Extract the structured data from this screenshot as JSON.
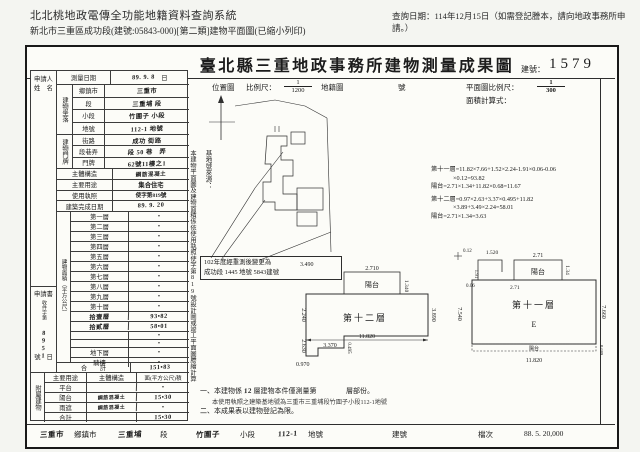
{
  "sys": {
    "title": "北北桃地政電傳全功能地籍資料查詢系統",
    "date_note": "查詢日期：114年12月15日（如需登記謄本，請向地政事務所申請。）",
    "subtitle": "新北市三重區成功段(建號:05843-000)[第二類]建物平面圖(已縮小列印)"
  },
  "doc": {
    "title": "臺北縣三重地政事務所建物測量成果圖",
    "bno_label": "建號：",
    "bno": "1579",
    "hdr": {
      "loc": "位置圖",
      "scale": "比例尺：",
      "s1n": "1",
      "s1d": "1200",
      "cad": "地籍圖",
      "no": "號",
      "pscale": "平面圖比例尺：",
      "s2n": "1",
      "s2d": "300",
      "formula": "面積計算式："
    },
    "vnote": "本建物平面圖及建物面積係依使用執照使字第819號設計圖或竣工平面圖謄繪計算",
    "base_src": "基地號來源：",
    "renote1": "102年度經重測後變更為",
    "renote2": "成功段 1445 地號 5843建號",
    "formulas": [
      "第十一層=11.82×7.66+1.52×2.24-1.91×0.06-0.06",
      "×0.12=93.82",
      "陽台=2.71×1.34+11.82×0.68=11.67",
      "第十二層=0.97×2.63+3.37×0.495+11.82",
      "×3.89+3.49×2.24=58.01",
      "陽台=2.71×1.34=3.63"
    ],
    "lt": {
      "applicant1": "申請人",
      "applicant2": "姓　名",
      "appbox": {
        "title": "申請書",
        "sub": "收件字第",
        "hand": "8951",
        "no": "號",
        "day": "日"
      },
      "survey_label": "測量日期",
      "survey_value": "89. 9. 8",
      "survey_suffix": "日",
      "loc_label": "建物坐落",
      "loc_rows": [
        {
          "l": "鄉鎮市",
          "v": "三重市"
        },
        {
          "l": "段",
          "v": "三重埔 段"
        },
        {
          "l": "小段",
          "v": "竹圍子 小段"
        },
        {
          "l": "地號",
          "v": "112-1 地號"
        }
      ],
      "door_label": "建物門牌",
      "door_rows": [
        {
          "l": "街路",
          "v": "成功 街路"
        },
        {
          "l": "段巷弄",
          "v": "段 50 巷　弄"
        },
        {
          "l": "門牌",
          "v": "62號11樓之1"
        }
      ],
      "rows": [
        {
          "l": "主體構造",
          "v": "鋼筋混凝土"
        },
        {
          "l": "主要用途",
          "v": "集合住宅"
        },
        {
          "l": "使用執照",
          "v": "使字第819號"
        },
        {
          "l": "建築完成日期",
          "v": "89. 9. 20"
        }
      ],
      "area_label": "建物面積（平方公尺）",
      "floors": [
        {
          "label": "第一層",
          "value": "•"
        },
        {
          "label": "第二層",
          "value": "•"
        },
        {
          "label": "第三層",
          "value": "•"
        },
        {
          "label": "第四層",
          "value": "•"
        },
        {
          "label": "第五層",
          "value": "•"
        },
        {
          "label": "第六層",
          "value": "•"
        },
        {
          "label": "第七層",
          "value": "•"
        },
        {
          "label": "第八層",
          "value": "•"
        },
        {
          "label": "第九層",
          "value": "•"
        },
        {
          "label": "第十層",
          "value": "•"
        },
        {
          "label": "拾壹層",
          "value": "93•82"
        },
        {
          "label": "拾貳層",
          "value": "58•01"
        },
        {
          "label": "",
          "value": "•"
        },
        {
          "label": "",
          "value": "•"
        },
        {
          "label": "地下層",
          "value": "•"
        },
        {
          "label": "騎樓",
          "value": "•"
        }
      ],
      "total_label": "合　　計",
      "total_value": "151•83",
      "annex_label": "附屬建物",
      "annex_headers": [
        "主要用途",
        "主體構造",
        "面(平方公尺)積"
      ],
      "annex_rows": [
        {
          "use": "平台",
          "structure": "",
          "area": "•"
        },
        {
          "use": "陽台",
          "structure": "鋼筋混凝土",
          "area": "15•30"
        },
        {
          "use": "雨遮",
          "structure": "鋼筋混凝土",
          "area": "•"
        },
        {
          "use": "合計",
          "structure": "",
          "area": "15•30"
        }
      ]
    },
    "plan12": {
      "name": "第十二層",
      "balcony": "陽台",
      "d_3490": "3.490",
      "d_2710": "2.710",
      "d_1340": "1.340",
      "d_3890": "3.890",
      "d_11820": "11.820",
      "d_3370": "3.370",
      "d_0495": "0.495",
      "d_0970": "0.970",
      "d_2630": "2.630",
      "d_2240": "2.240"
    },
    "plan11": {
      "name": "第十一層",
      "letter": "E",
      "balcony": "陽台",
      "strip": "陽台",
      "d_1520": "1.520",
      "d_271a": "2.71",
      "d_134": "1.34",
      "d_271b": "2.71",
      "d_191": "1.91",
      "d_006": "0.06",
      "d_012": "0.12",
      "d_7660": "7.660",
      "d_11820": "11.820",
      "d_0689": "0.689",
      "d_7540": "7.540"
    },
    "notes": {
      "n1a": "一、本建物係",
      "n1hand": "12",
      "n1b": "層建物本件僅測量第",
      "n1c": "層部份。",
      "stamp": "本使用執照之建築基地號為三重市三重埔段竹圍子小段112-1地號",
      "n2": "二、本成果表以建物登記為限。"
    },
    "strip": [
      {
        "t": "三重市"
      },
      {
        "t": "鄉鎮市"
      },
      {
        "t": "三重埔"
      },
      {
        "t": "段"
      },
      {
        "t": "竹圍子"
      },
      {
        "t": "小段"
      },
      {
        "t": "112-1"
      },
      {
        "t": "地號"
      },
      {
        "t": "建號"
      },
      {
        "t": "檔次"
      },
      {
        "t": "88. 5. 20,000"
      }
    ]
  }
}
